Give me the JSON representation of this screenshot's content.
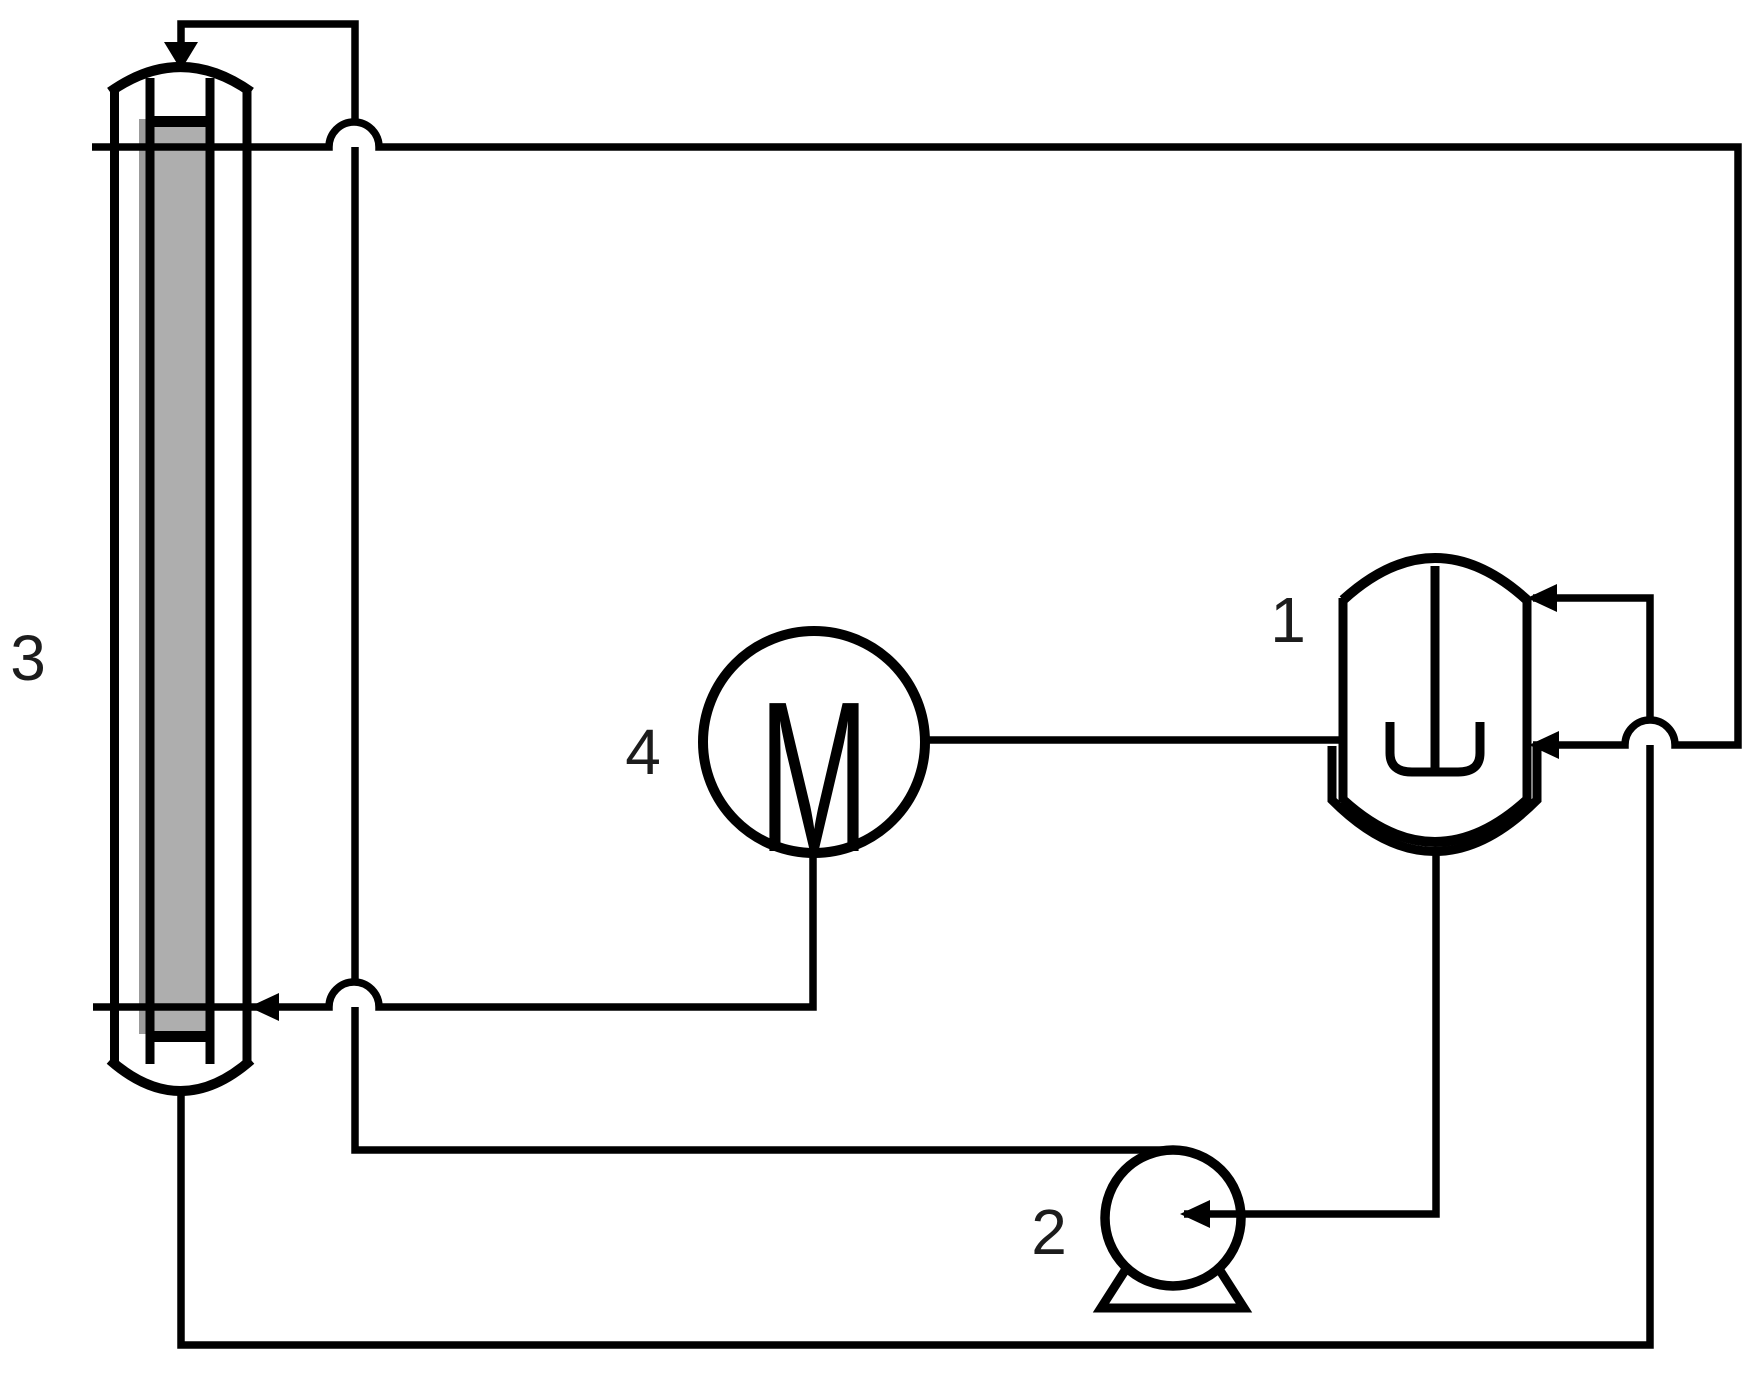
{
  "diagram": {
    "labels": {
      "reactor": "1",
      "pump": "2",
      "column": "3",
      "motor": "4"
    },
    "motor_letter": "M",
    "colors": {
      "line": "#000000",
      "membrane_fill": "#aeaeae",
      "membrane_shadow": "#9b9b9b",
      "background": "#ffffff"
    }
  }
}
